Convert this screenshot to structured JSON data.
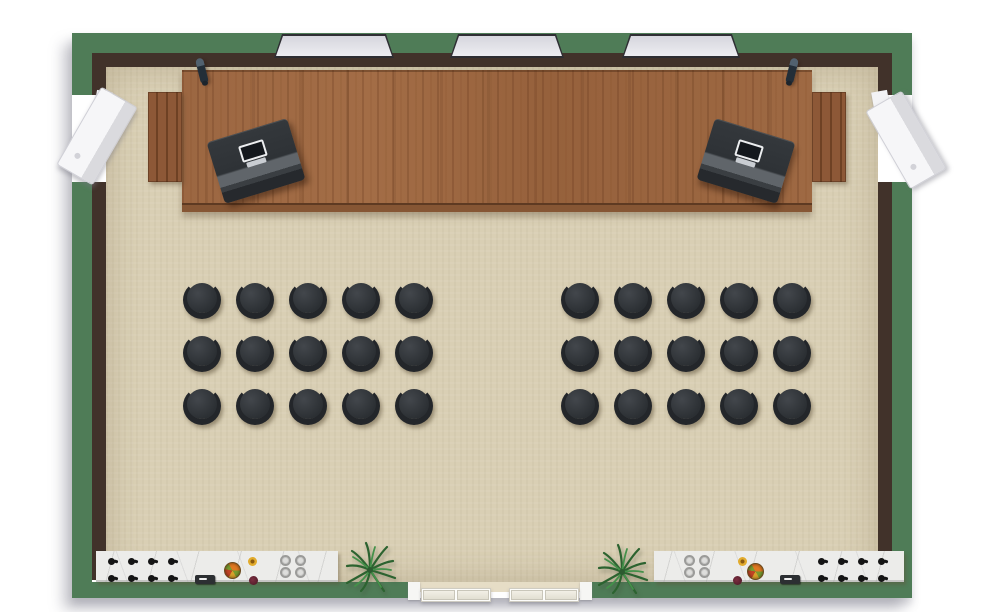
{
  "scene": {
    "description": "Top-down 3D floor plan render of a lecture and demonstration hall",
    "visible_text": "none"
  },
  "colors": {
    "background": "#ffffff",
    "wall_green": "#4f7c57",
    "wall_trim": "#41322a",
    "floor_tan": "#d9cfb4",
    "stage_wood": "#9c6742",
    "stage_front": "#865634",
    "step_wood": "#8d5837",
    "desk_band": "#60656a",
    "chair_dark": "#2b2f33",
    "chair_back": "#23262a",
    "counter_marble": "#ececea",
    "speaker_white": "#f6f6f8",
    "door_panel": "#e2dfd2",
    "plant_green_dark": "#2c6330",
    "plant_green_light": "#44914a"
  },
  "walls": {
    "window_count": 3,
    "speaker_count": 2,
    "entry_door_sets": 2
  },
  "stage": {
    "material": "wood-grain platform",
    "lecterns": 2,
    "laptops": 2,
    "microphones": 2,
    "step_flights": 2
  },
  "seating": {
    "total_chairs": 30,
    "groups": [
      {
        "side": "left",
        "rows": 3,
        "cols": 5
      },
      {
        "side": "right",
        "rows": 3,
        "cols": 5
      }
    ]
  },
  "counters": [
    {
      "side": "left",
      "material": "marble",
      "control_knobs": {
        "rows": 2,
        "cols": 4
      },
      "burners": {
        "rows": 2,
        "cols": 2
      },
      "items": [
        "fruit-bowl",
        "flower",
        "sauce-bowl",
        "appliance"
      ]
    },
    {
      "side": "right",
      "material": "marble",
      "control_knobs": {
        "rows": 2,
        "cols": 4
      },
      "burners": {
        "rows": 2,
        "cols": 2
      },
      "items": [
        "fruit-bowl",
        "flower",
        "sauce-bowl",
        "appliance"
      ]
    }
  ],
  "plants": {
    "count": 2
  },
  "doors": {
    "count": 2,
    "leaves_per_door": 2,
    "location": "bottom-center"
  }
}
